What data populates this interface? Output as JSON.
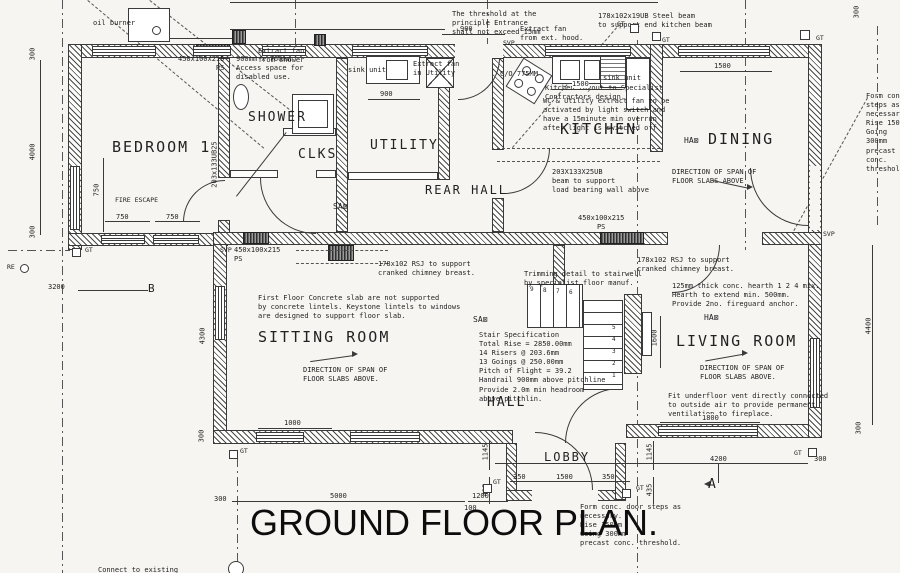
{
  "colors": {
    "ink": "#3a3a3a",
    "paper": "#f6f5f2"
  },
  "title": "GROUND FLOOR PLAN.",
  "rooms": {
    "bedroom1": "BEDROOM 1",
    "shower": "SHOWER",
    "clks": "CLKS",
    "utility": "UTILITY",
    "rear_hall": "REAR HALL",
    "kitchen": "KITCHEN",
    "dining": "DINING",
    "sitting_room": "SITTING ROOM",
    "hall": "HALL",
    "living_room": "LIVING ROOM",
    "lobby": "LOBBY"
  },
  "annotations": {
    "oil_burner": "oil burner",
    "threshold": "The threshold at the\nprinciple Entrance\nshall not exceed 15mm",
    "extract_hood": "Extract fan\nfrom ext. hood.",
    "steel_beam": "178x102x19UB Steel beam\nto support end kitchen beam",
    "access_space": "900mm x 760mm\nAccess space for\ndisabled use.",
    "extract_shower": "Extract fan\nfrom shower",
    "sink_unit_utility": "sink unit",
    "sink_unit_kitchen": "sink unit",
    "extract_utility": "Extract fan\nin Utility",
    "co775": "C/O 775MM",
    "wc_extract": "WC & Utility extract fan to be\nactivated by light switch and\nhave a 15minute min overrun\nafter light is switched off",
    "kitchen_layout": "Kitchen layout to Specialist\nContractors design.",
    "beam_203": "203X133X25UB\nbeam to support\nload bearing wall above",
    "beam_203_vert": "203x133UB25",
    "span_dining": "DIRECTION OF SPAN OF\nFLOOR SLABS ABOVE",
    "span_sitting": "DIRECTION OF SPAN OF\nFLOOR SLABS ABOVE.",
    "span_living": "DIRECTION OF SPAN OF\nFLOOR SLABS ABOVE.",
    "rsj_sitting": "178x102 RSJ to support\ncranked chimney breast.",
    "rsj_living": "178x102 RSJ to support\ncranked chimney breast.",
    "trimming": "Trimming detail to stairwell\nby specialist floor manuf.",
    "hearth": "125mm thick conc. hearth 1 2 4 mix.\nHearth to extend min. 500mm.\nProvide 2no. fireguard anchor.",
    "slab_note": "First Floor Concrete slab are not supported\nby concrete lintels. Keystone lintels to windows\nare designed to support floor slab.",
    "stair_spec": "Stair Specification\nTotal Rise = 2850.00mm\n14 Risers @ 203.6mm\n13 Goings @ 250.00mm\nPitch of Flight = 39.2\nHandrail 900mm above pitchline\nProvide 2.0m min headroom\nabove pitchlin.",
    "underfloor_vent": "Fit underfloor vent directly connected\nto outside air to provide permanent\nventilation to fireplace.",
    "form_steps_right": "Form conc. steps as\nnecessary.\nRise 150mm\nGoing 300mm\nprecast conc. threshold.",
    "form_steps_bottom": "Form conc. door steps as\nnecessary.\nRise 150mm\nGoing 300mm\nprecast conc. threshold.",
    "connect_note": "Connect to existing",
    "fire_escape": "FIRE ESCAPE",
    "lintel_ps_top": "450x100x215\nPS",
    "lintel_ps_left": "450x100x215\nPS",
    "lintel_ps_mid": "450x100x215\nPS"
  },
  "dims": {
    "left_300_top": "300",
    "left_4000": "4000",
    "left_300_bot": "300",
    "fire_escape_750": "750",
    "bed_750_a": "750",
    "bed_750_b": "750",
    "b_3200": "3200",
    "sit_4300": "4300",
    "sit_1000": "1000",
    "bot_5000": "5000",
    "bot_1200": "1200",
    "bot_100": "100",
    "lobby_350_l": "350",
    "lobby_1500": "1500",
    "lobby_350_r": "350",
    "lobby_1145_l": "1145",
    "lobby_435_l": "435",
    "lobby_1145_r": "1145",
    "lobby_435_r": "435",
    "liv_1800": "1800",
    "liv_4200": "4200",
    "liv_300": "300",
    "right_300": "300",
    "right_4400": "4400",
    "fire_1600": "1600",
    "din_1500": "1500",
    "kit_1500": "1500",
    "top_900": "900",
    "util_900": "900",
    "lob_300_a": "300",
    "lob_300_b": "300",
    "tr_300": "300"
  },
  "markers": {
    "gt": "GT",
    "svp": "SVP",
    "re": "RE",
    "sa": "SA⊠",
    "ha": "HA⊠",
    "sec_a": "A",
    "sec_b": "B"
  },
  "stairs": {
    "lower": [
      "5",
      "4",
      "3",
      "2",
      "1"
    ],
    "upper": [
      "9",
      "8",
      "7",
      "6"
    ]
  }
}
